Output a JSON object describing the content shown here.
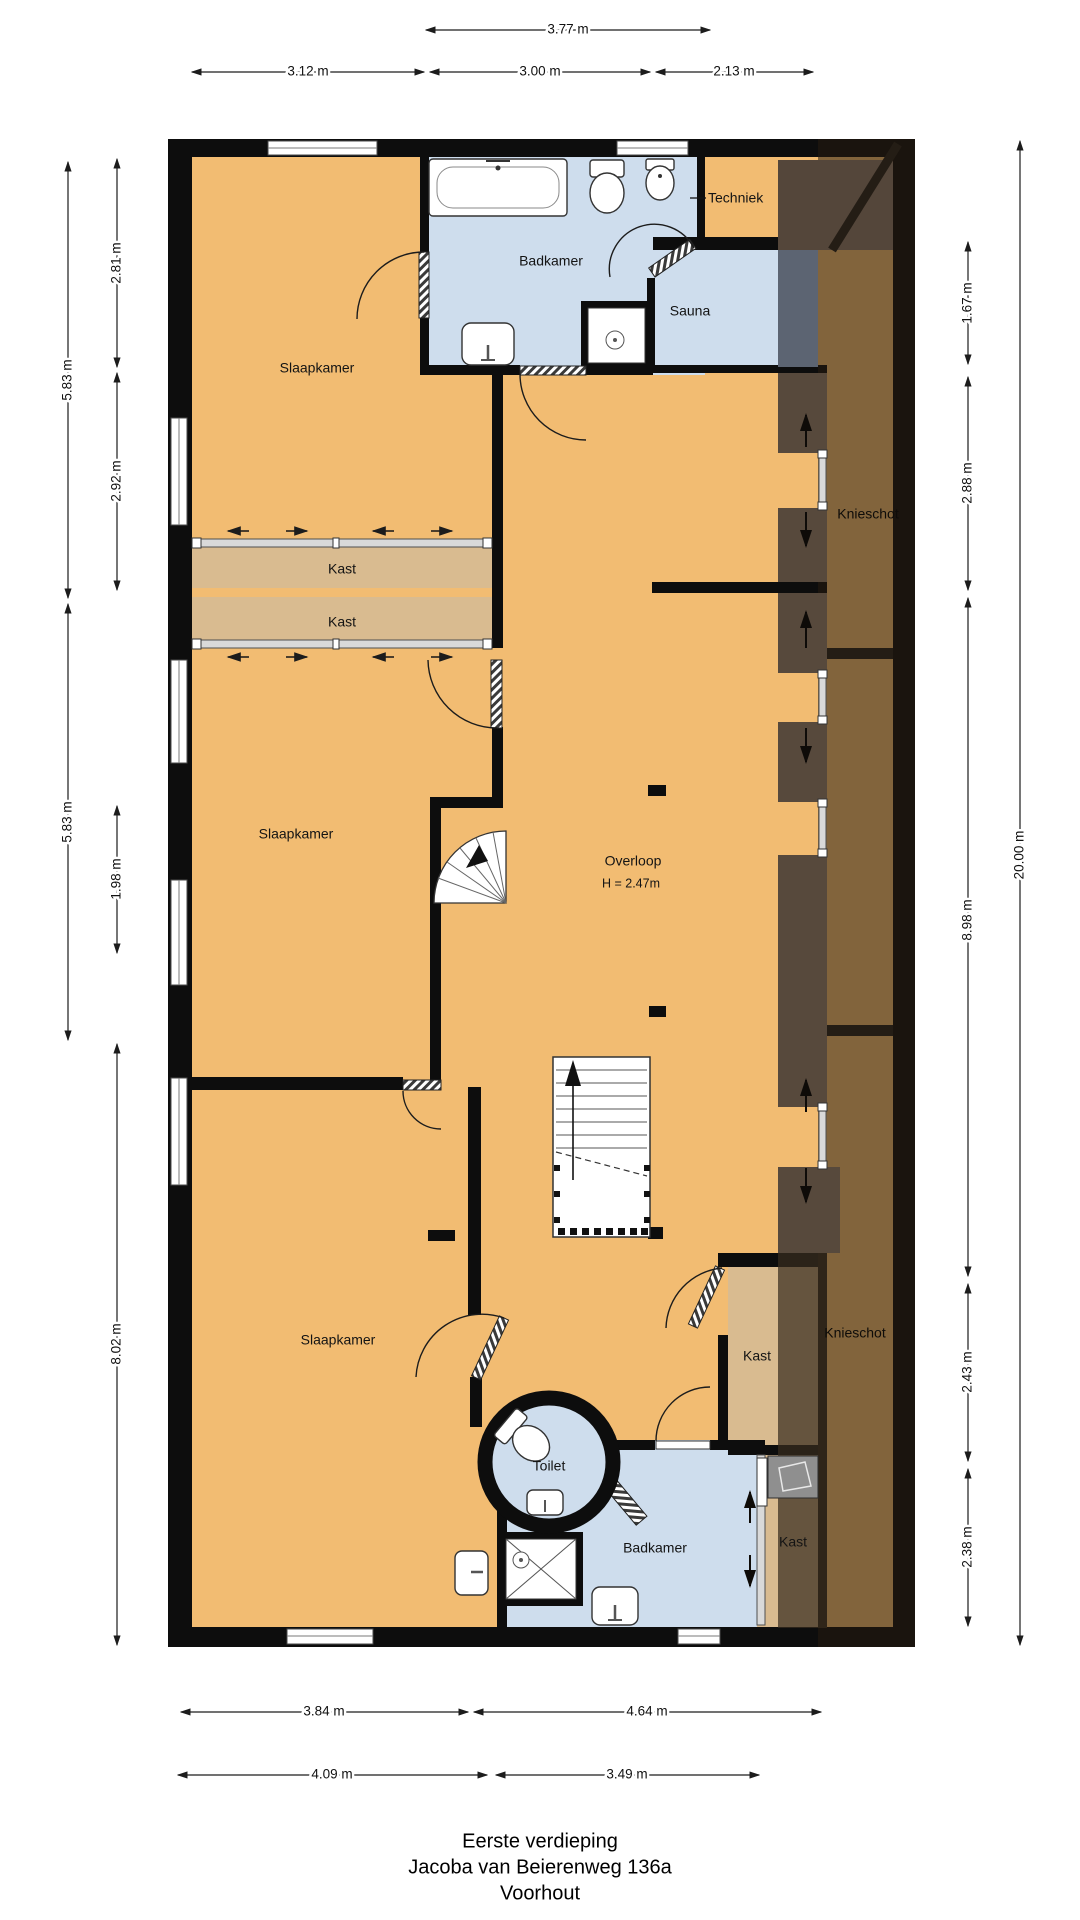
{
  "title_block": {
    "floor": "Eerste verdieping",
    "address": "Jacoba van Beierenweg 136a",
    "city": "Voorhout"
  },
  "rooms": {
    "slaapkamer_top": "Slaapkamer",
    "slaapkamer_mid": "Slaapkamer",
    "slaapkamer_bottom": "Slaapkamer",
    "badkamer_top": "Badkamer",
    "badkamer_bottom": "Badkamer",
    "techniek": "Techniek",
    "sauna": "Sauna",
    "kast_1": "Kast",
    "kast_2": "Kast",
    "kast_3": "Kast",
    "kast_4": "Kast",
    "knieschot_top": "Knieschot",
    "knieschot_bottom": "Knieschot",
    "overloop": "Overloop",
    "overloop_height": "H = 2.47m",
    "toilet": "Toilet"
  },
  "dimensions": {
    "top_width": "3.77 m",
    "top_left": "3.12 m",
    "top_middle": "3.00 m",
    "top_right": "2.13 m",
    "left_upper_outer": "5.83 m",
    "left_middle_outer": "5.83 m",
    "left_upper_inner": "2.81 m",
    "left_mid_inner": "2.92 m",
    "left_lower_inner": "1.98 m",
    "left_bottom": "8.02 m",
    "right_1": "1.67 m",
    "right_2": "2.88 m",
    "right_3": "8.98 m",
    "right_4": "2.43 m",
    "right_5": "2.38 m",
    "right_total": "20.00 m",
    "bottom_left_1": "3.84 m",
    "bottom_right_1": "4.64 m",
    "bottom_left_2": "4.09 m",
    "bottom_right_2": "3.49 m"
  },
  "colors": {
    "floor": "#f2bc72",
    "closet": "#d9bb90",
    "wet_room": "#cedded",
    "wall": "#0d0d0d",
    "attic_dark": "#57493c",
    "attic_overlay": "rgba(38,28,16,0.55)"
  }
}
